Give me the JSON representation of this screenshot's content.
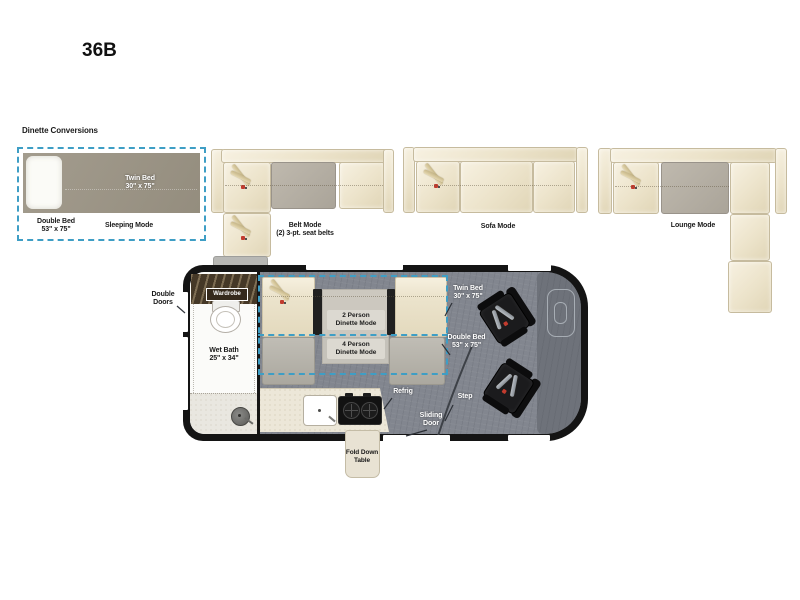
{
  "title": "36B",
  "conversions": {
    "heading": "Dinette Conversions",
    "sleeping": {
      "twin_bed_label": "Twin Bed\n30\" x 75\"",
      "double_bed_label": "Double Bed\n53\" x 75\"",
      "mode_label": "Sleeping Mode"
    },
    "belt": {
      "mode_label": "Belt Mode\n(2) 3-pt. seat belts"
    },
    "sofa": {
      "mode_label": "Sofa Mode"
    },
    "lounge": {
      "mode_label": "Lounge Mode"
    }
  },
  "floorplan": {
    "double_doors_label": "Double\nDoors",
    "wardrobe_label": "Wardrobe",
    "wet_bath_label": "Wet Bath\n25\" x 34\"",
    "dinette_2_person_label": "2 Person\nDinette Mode",
    "dinette_4_person_label": "4 Person\nDinette Mode",
    "twin_bed_label": "Twin Bed\n30\" x 75\"",
    "double_bed_label": "Double Bed\n53\" x 75\"",
    "refrig_label": "Refrig",
    "step_label": "Step",
    "sliding_door_label": "Sliding\nDoor",
    "fold_down_table_label": "Fold Down\nTable"
  },
  "colors": {
    "dash_accent": "#3e9ec5",
    "cushion_cream": "#ede6d0",
    "table_gray": "#b4aea3",
    "bed_gray": "#9b9486",
    "floor_gray": "#82868f",
    "cab_gray": "#6e727a",
    "wardrobe_brown": "#42362a",
    "counter_cream": "#ece7d8",
    "chair_black": "#1b1b1d",
    "belt_tan": "#d9cba2",
    "buckle_red": "#c23b2e"
  },
  "icons": {
    "seat-belt-icon": "two tan diagonal straps with red buckle",
    "shower-head-icon": "gray circle with center dot",
    "toilet-icon": "white oval bowl with tank",
    "steering-wheel-icon": "rounded rectangle outline with inner pill",
    "sink-icon": "white rounded square with faucet dot",
    "stove-icon": "black rectangle with two cross burners",
    "pillow-icon": "white rounded rectangle"
  }
}
